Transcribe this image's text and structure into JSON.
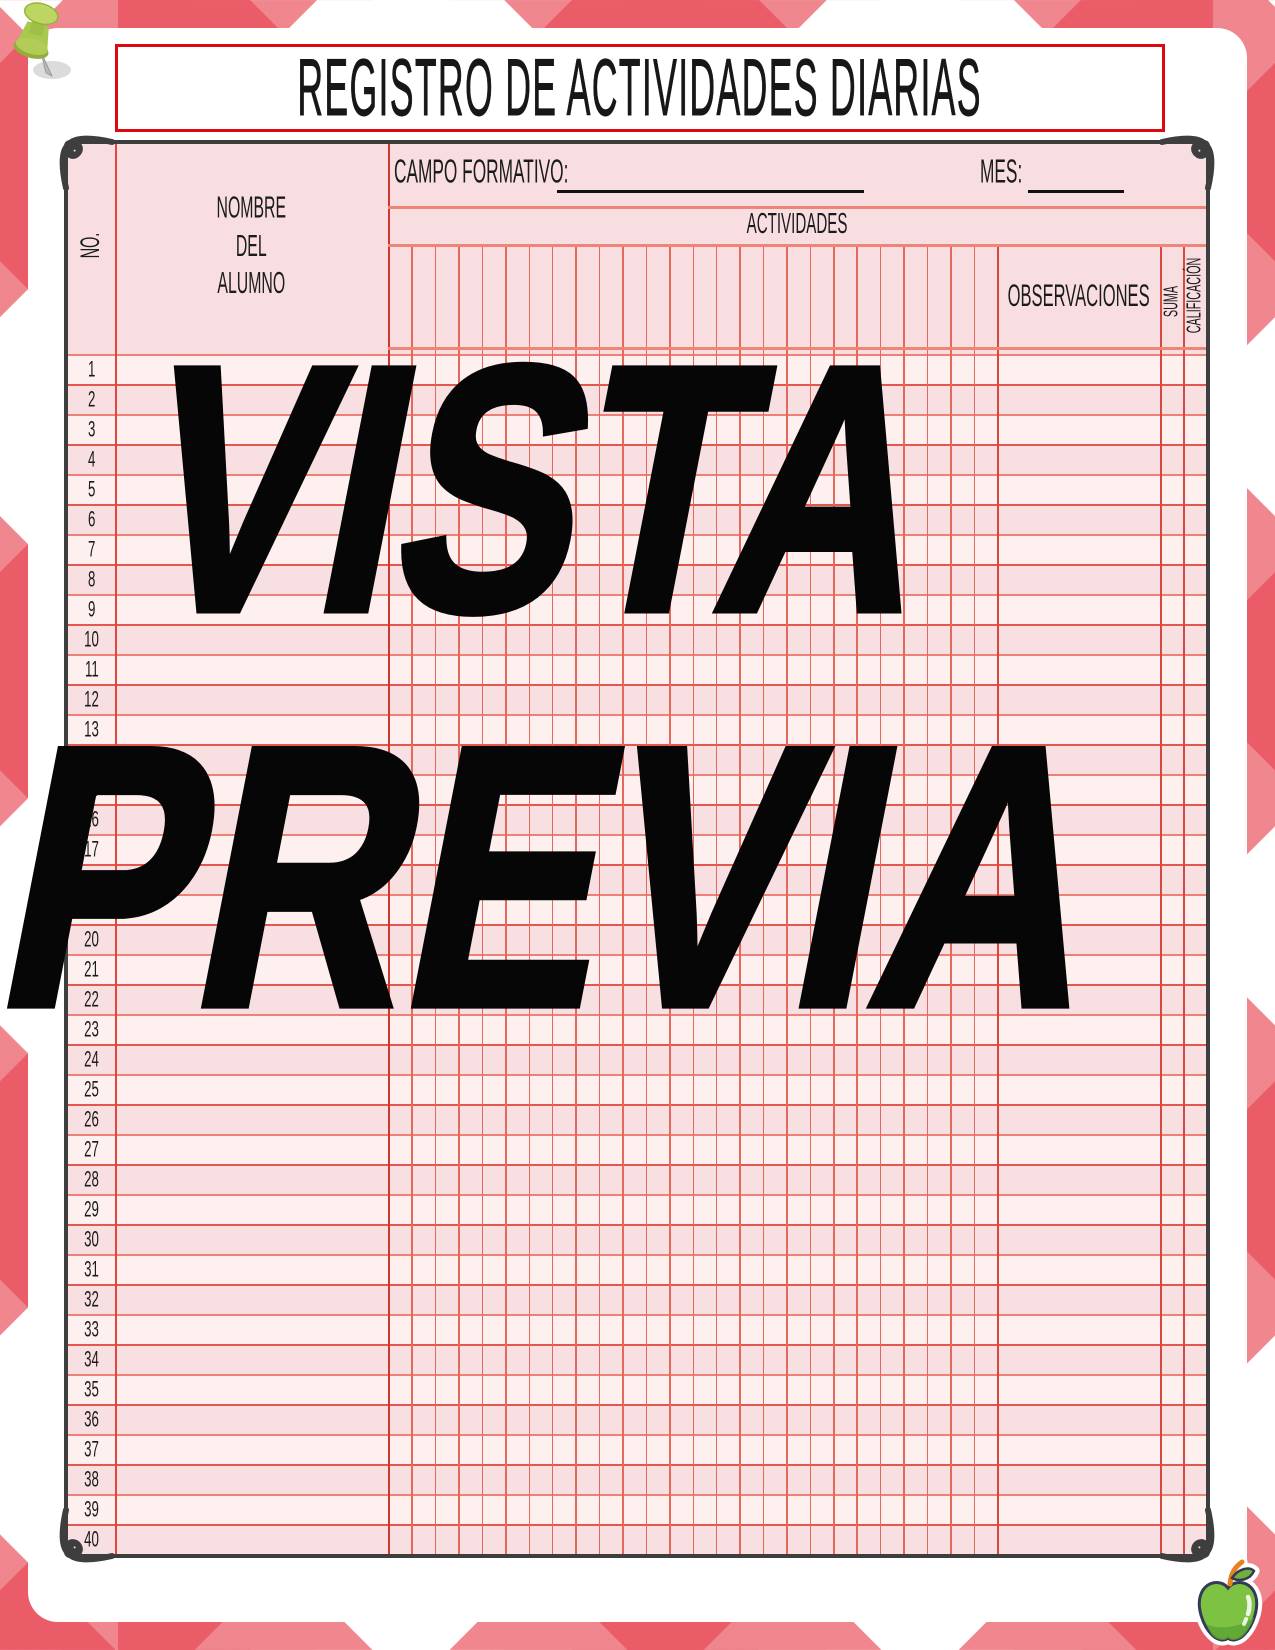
{
  "title": "REGISTRO DE ACTIVIDADES DIARIAS",
  "watermark": {
    "line1": "VISTA",
    "line2": "PREVIA"
  },
  "table": {
    "no_label": "NO.",
    "student_label": "NOMBRE\nDEL\nALUMNO",
    "campo_label": "CAMPO FORMATIVO:",
    "campo_value": "",
    "mes_label": "MES:",
    "mes_value": "",
    "actividades_label": "ACTIVIDADES",
    "observaciones_label": "OBSERVACIONES",
    "suma_label": "SUMA",
    "calificacion_label": "CALIFICACIÓN",
    "activity_column_count": 26,
    "row_numbers": [
      1,
      2,
      3,
      4,
      5,
      6,
      7,
      8,
      9,
      10,
      11,
      12,
      13,
      14,
      15,
      16,
      17,
      18,
      19,
      20,
      21,
      22,
      23,
      24,
      25,
      26,
      27,
      28,
      29,
      30,
      31,
      32,
      33,
      34,
      35,
      36,
      37,
      38,
      39,
      40
    ]
  },
  "decorations": {
    "pushpin_icon": "green-pushpin",
    "apple_icon": "green-apple",
    "corner_flourish": "scroll-curl"
  },
  "colors": {
    "pattern_red": "#e84f5c",
    "pattern_coral": "#ef8b8f",
    "sheet_pink": "#f8dee1",
    "row_light": "#fdf0ef",
    "row_dark": "#f8dfe1",
    "grid_salmon": "#ee8177",
    "grid_red": "#e0473d",
    "frame_dark": "#3e3e3e",
    "title_border_red": "#de0713",
    "watermark_black": "#060606",
    "apple_green": "#7dc242",
    "pushpin_green": "#b8cf5e"
  }
}
